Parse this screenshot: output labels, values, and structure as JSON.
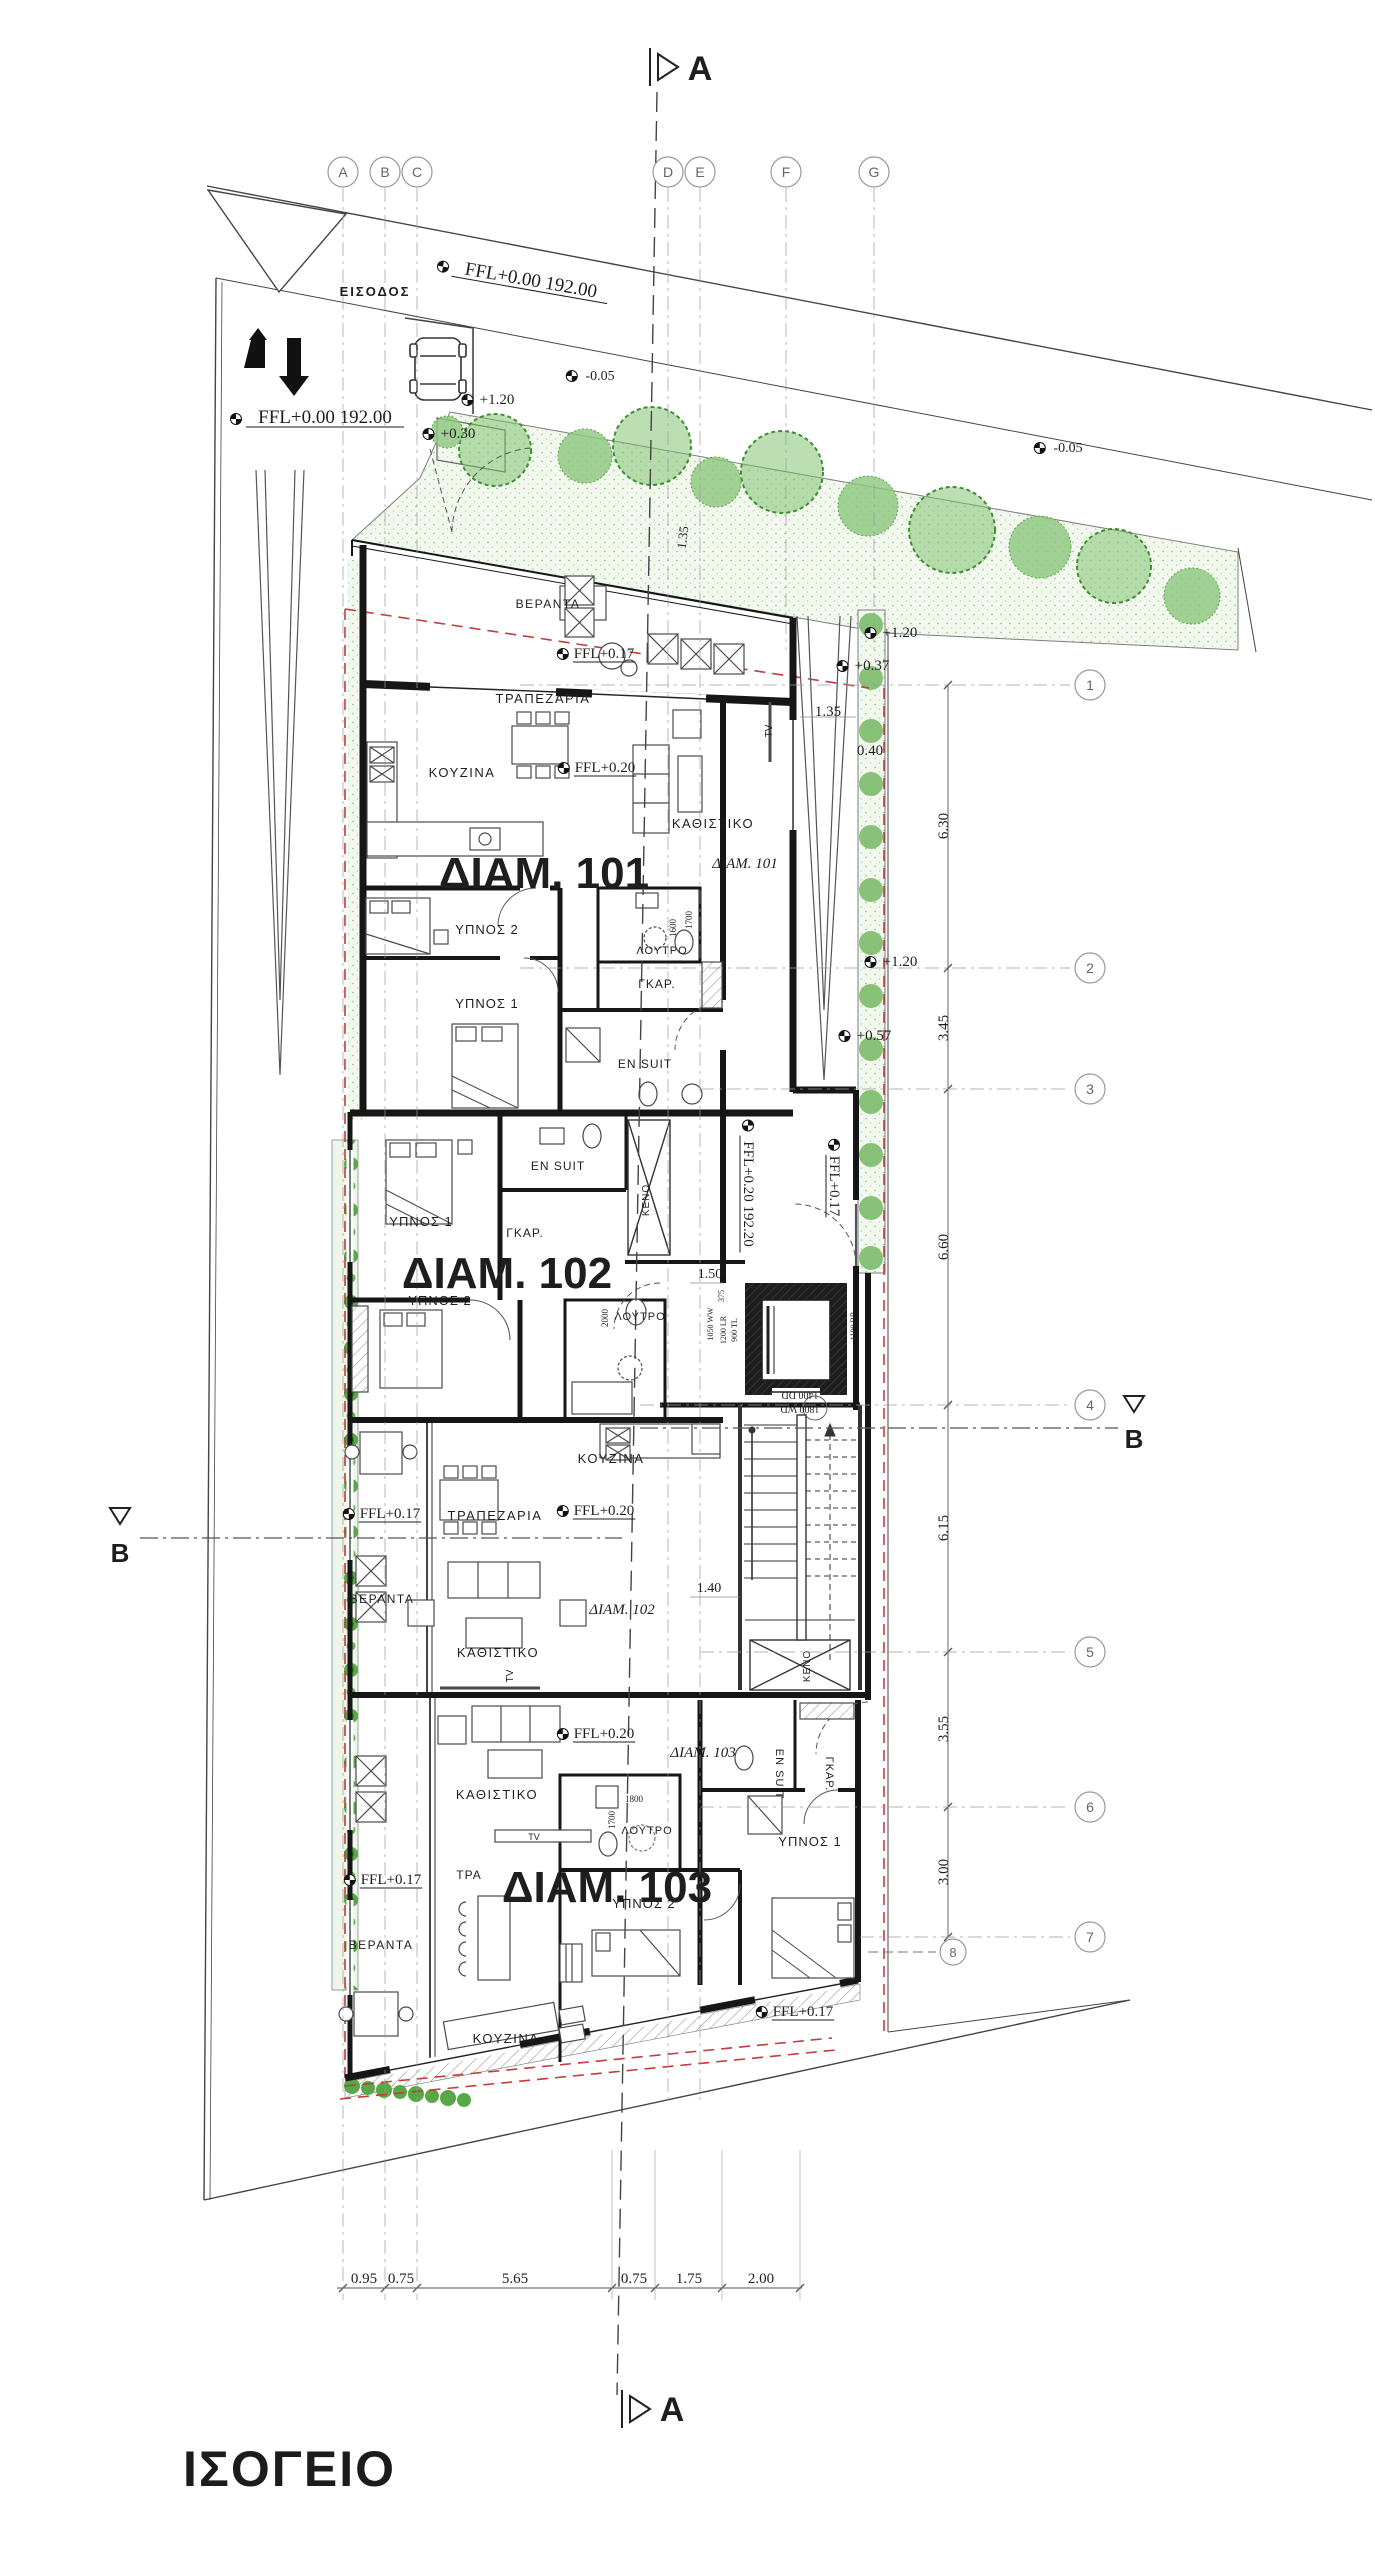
{
  "title": "ΙΣΟΓΕΙΟ",
  "colors": {
    "wall": "#161616",
    "line": "#3a3a3a",
    "green_tree": "#5aa84b",
    "green_bg": "#f3f8ef",
    "red_boundary": "#c43c3c",
    "grid_gray": "#8a8a8a",
    "text": "#222222"
  },
  "grid": {
    "columns": [
      {
        "label": "A",
        "x": 343,
        "end": 2300
      },
      {
        "label": "B",
        "x": 385,
        "end": 2300
      },
      {
        "label": "C",
        "x": 417,
        "end": 2300
      },
      {
        "label": "D",
        "x": 668,
        "end": 2105
      },
      {
        "label": "E",
        "x": 700,
        "end": 2105
      },
      {
        "label": "F",
        "x": 786,
        "end": 650
      },
      {
        "label": "G",
        "x": 874,
        "end": 650
      }
    ],
    "rows": [
      {
        "label": "1",
        "y": 685,
        "x0": 520
      },
      {
        "label": "2",
        "y": 968,
        "x0": 520
      },
      {
        "label": "3",
        "y": 1089,
        "x0": 700
      },
      {
        "label": "4",
        "y": 1405,
        "x0": 640
      },
      {
        "label": "5",
        "y": 1652,
        "x0": 700
      },
      {
        "label": "6",
        "y": 1807,
        "x0": 700
      },
      {
        "label": "7",
        "y": 1937,
        "x0": 860
      }
    ],
    "extra_row": {
      "label": "8",
      "cx": 953,
      "cy": 1952
    }
  },
  "plan": {
    "labels": [
      {
        "n": "entrance-label",
        "t": "ΕΙΣΟΔΟΣ",
        "x": 375,
        "y": 296,
        "s": 13,
        "w": 700,
        "ls": 2
      },
      {
        "n": "ffl-street",
        "t": "FFL+0.00  192.00",
        "x": 530,
        "y": 286,
        "s": 19,
        "f": "serif",
        "r": 10,
        "u": 1,
        "m": 1
      },
      {
        "n": "ffl-drive",
        "t": "FFL+0.00  192.00",
        "x": 325,
        "y": 423,
        "s": 19,
        "f": "serif",
        "u": 1,
        "m": 1
      },
      {
        "t": "+1.20",
        "x": 497,
        "y": 404,
        "s": 15,
        "f": "serif",
        "m": 1
      },
      {
        "t": "+0.30",
        "x": 458,
        "y": 438,
        "s": 15,
        "f": "serif",
        "m": 1
      },
      {
        "t": "-0.05",
        "x": 600,
        "y": 380,
        "s": 14,
        "f": "serif",
        "m": 1
      },
      {
        "t": "-0.05",
        "x": 1068,
        "y": 452,
        "s": 14,
        "f": "serif",
        "m": 1
      },
      {
        "t": "+1.20",
        "x": 900,
        "y": 637,
        "s": 15,
        "f": "serif",
        "m": 1
      },
      {
        "t": "+0.37",
        "x": 872,
        "y": 670,
        "s": 15,
        "f": "serif",
        "m": 1
      },
      {
        "t": "1.35",
        "x": 828,
        "y": 716,
        "s": 15,
        "f": "serif"
      },
      {
        "t": "0.40",
        "x": 870,
        "y": 755,
        "s": 15,
        "f": "serif"
      },
      {
        "t": "1.35",
        "x": 687,
        "y": 538,
        "s": 13,
        "f": "serif",
        "r": -83
      },
      {
        "t": "+1.20",
        "x": 900,
        "y": 966,
        "s": 15,
        "f": "serif",
        "m": 1
      },
      {
        "t": "+0.57",
        "x": 874,
        "y": 1040,
        "s": 15,
        "f": "serif",
        "m": 1
      },
      {
        "t": "ΒΕΡΑΝΤΑ",
        "x": 548,
        "y": 608,
        "s": 12,
        "ls": 1.5
      },
      {
        "t": "FFL+0.17",
        "x": 604,
        "y": 658,
        "s": 15,
        "f": "serif",
        "u": 1,
        "m": 1
      },
      {
        "t": "ΤΡΑΠΕΖΑΡΙΑ",
        "x": 543,
        "y": 703,
        "s": 13,
        "ls": 1.5
      },
      {
        "t": "ΚΟΥΖΙΝΑ",
        "x": 462,
        "y": 777,
        "s": 13,
        "ls": 1.5
      },
      {
        "t": "FFL+0.20",
        "x": 605,
        "y": 772,
        "s": 15,
        "f": "serif",
        "u": 1,
        "m": 1
      },
      {
        "t": "ΚΑΘΙΣΤΙΚΟ",
        "x": 713,
        "y": 828,
        "s": 13,
        "ls": 1.5
      },
      {
        "n": "apt-101-big",
        "t": "ΔΙΑΜ. 101",
        "x": 544,
        "y": 888,
        "s": 44,
        "w": 800
      },
      {
        "n": "apt-101-small",
        "t": "ΔΙΑΜ. 101",
        "x": 745,
        "y": 868,
        "s": 15,
        "f": "serif",
        "i": 1
      },
      {
        "t": "ΥΠΝΟΣ 2",
        "x": 487,
        "y": 934,
        "s": 13,
        "ls": 1
      },
      {
        "t": "ΛΟΥΤΡΟ",
        "x": 662,
        "y": 954,
        "s": 11,
        "ls": 1
      },
      {
        "t": "1600",
        "x": 676,
        "y": 928,
        "s": 9,
        "f": "serif",
        "r": -90
      },
      {
        "t": "1700",
        "x": 692,
        "y": 920,
        "s": 9,
        "f": "serif",
        "r": -90
      },
      {
        "t": "ΓΚΑΡ.",
        "x": 657,
        "y": 988,
        "s": 12,
        "ls": 1
      },
      {
        "t": "ΥΠΝΟΣ 1",
        "x": 487,
        "y": 1008,
        "s": 13,
        "ls": 1
      },
      {
        "t": "EN SUIT",
        "x": 645,
        "y": 1068,
        "s": 12,
        "ls": 1
      },
      {
        "t": "TV",
        "x": 772,
        "y": 731,
        "s": 10,
        "r": -90
      },
      {
        "t": "FFL+0.17",
        "x": 830,
        "y": 1186,
        "s": 15,
        "f": "serif",
        "r": 90,
        "u": 1,
        "m": 1
      },
      {
        "t": "FFL+0.20 192.20",
        "x": 744,
        "y": 1194,
        "s": 15,
        "f": "serif",
        "r": 90,
        "u": 1,
        "m": 1
      },
      {
        "t": "1.50",
        "x": 710,
        "y": 1278,
        "s": 14,
        "f": "serif"
      },
      {
        "t": "375",
        "x": 724,
        "y": 1296,
        "s": 8,
        "f": "serif",
        "r": -90
      },
      {
        "t": "1050 WW",
        "x": 713,
        "y": 1324,
        "s": 8,
        "f": "serif",
        "r": -90
      },
      {
        "t": "1200 LR",
        "x": 726,
        "y": 1330,
        "s": 8,
        "f": "serif",
        "r": -90
      },
      {
        "t": "900 TL",
        "x": 737,
        "y": 1330,
        "s": 8,
        "f": "serif",
        "r": -90
      },
      {
        "t": "1100 BB",
        "x": 856,
        "y": 1326,
        "s": 8,
        "f": "serif",
        "r": -90
      },
      {
        "t": "1400 DD",
        "x": 800,
        "y": 1392,
        "s": 10,
        "f": "serif",
        "r": 180
      },
      {
        "t": "1800 WD",
        "x": 800,
        "y": 1406,
        "s": 10,
        "f": "serif",
        "r": 180
      },
      {
        "t": "EN SUIT",
        "x": 558,
        "y": 1170,
        "s": 12,
        "ls": 1
      },
      {
        "t": "ΥΠΝΟΣ 1",
        "x": 421,
        "y": 1226,
        "s": 13,
        "ls": 1
      },
      {
        "t": "ΓΚΑΡ.",
        "x": 525,
        "y": 1237,
        "s": 12,
        "ls": 1
      },
      {
        "n": "apt-102-big",
        "t": "ΔΙΑΜ. 102",
        "x": 507,
        "y": 1288,
        "s": 44,
        "w": 800
      },
      {
        "t": "ΥΠΝΟΣ 2",
        "x": 440,
        "y": 1305,
        "s": 13,
        "ls": 1
      },
      {
        "t": "ΚΕΝΟ",
        "x": 649,
        "y": 1200,
        "s": 10,
        "r": -90,
        "ls": 1
      },
      {
        "t": "2000",
        "x": 608,
        "y": 1318,
        "s": 9,
        "f": "serif",
        "r": -90
      },
      {
        "t": "ΛΟΥΤΡΟ",
        "x": 640,
        "y": 1320,
        "s": 11,
        "ls": 1
      },
      {
        "t": "ΚΟΥΖΙΝΑ",
        "x": 611,
        "y": 1463,
        "s": 13,
        "ls": 1.5
      },
      {
        "t": "FFL+0.17",
        "x": 390,
        "y": 1518,
        "s": 15,
        "f": "serif",
        "u": 1,
        "m": 1
      },
      {
        "t": "FFL+0.20",
        "x": 604,
        "y": 1515,
        "s": 15,
        "f": "serif",
        "u": 1,
        "m": 1
      },
      {
        "t": "ΤΡΑΠΕΖΑΡΙΑ",
        "x": 495,
        "y": 1520,
        "s": 13,
        "ls": 1.5
      },
      {
        "t": "ΒΕΡΑΝΤΑ",
        "x": 382,
        "y": 1603,
        "s": 12,
        "ls": 1.5
      },
      {
        "t": "ΚΑΘΙΣΤΙΚΟ",
        "x": 498,
        "y": 1657,
        "s": 13,
        "ls": 1.5
      },
      {
        "n": "apt-102-small",
        "t": "ΔΙΑΜ. 102",
        "x": 622,
        "y": 1614,
        "s": 15,
        "f": "serif",
        "i": 1
      },
      {
        "t": "1.40",
        "x": 709,
        "y": 1592,
        "s": 14,
        "f": "serif"
      },
      {
        "t": "ΚΑΘΙΣΤΙΚΟ",
        "x": 497,
        "y": 1799,
        "s": 13,
        "ls": 1.5
      },
      {
        "t": "FFL+0.20",
        "x": 604,
        "y": 1738,
        "s": 15,
        "f": "serif",
        "u": 1,
        "m": 1
      },
      {
        "n": "apt-103-small",
        "t": "ΔΙΑΜ. 103",
        "x": 703,
        "y": 1757,
        "s": 15,
        "f": "serif",
        "i": 1
      },
      {
        "t": "EN SUIT",
        "x": 776,
        "y": 1774,
        "s": 11,
        "r": 90,
        "ls": 1
      },
      {
        "t": "ΓΚΑΡ.",
        "x": 826,
        "y": 1774,
        "s": 11,
        "r": 90,
        "ls": 1
      },
      {
        "t": "ΚΕΝΟ",
        "x": 810,
        "y": 1666,
        "s": 10,
        "r": -90,
        "ls": 1
      },
      {
        "t": "ΥΠΝΟΣ 1",
        "x": 810,
        "y": 1846,
        "s": 13,
        "ls": 1
      },
      {
        "t": "ΛΟΥΤΡΟ",
        "x": 647,
        "y": 1834,
        "s": 11,
        "ls": 1
      },
      {
        "t": "1800",
        "x": 634,
        "y": 1802,
        "s": 9,
        "f": "serif"
      },
      {
        "t": "1700",
        "x": 615,
        "y": 1820,
        "s": 9,
        "f": "serif",
        "r": -90
      },
      {
        "t": "TV",
        "x": 513,
        "y": 1676,
        "s": 10,
        "r": -90
      },
      {
        "t": "TV",
        "x": 534,
        "y": 1840,
        "s": 9
      },
      {
        "n": "apt-103-big",
        "t": "ΔΙΑΜ. 103",
        "x": 607,
        "y": 1902,
        "s": 44,
        "w": 800
      },
      {
        "t": "ΤΡΑ",
        "x": 469,
        "y": 1879,
        "s": 12,
        "ls": 1
      },
      {
        "t": "ΥΠΝΟΣ 2",
        "x": 644,
        "y": 1908,
        "s": 13,
        "ls": 1
      },
      {
        "t": "ΒΕΡΑΝΤΑ",
        "x": 381,
        "y": 1949,
        "s": 12,
        "ls": 1.5
      },
      {
        "t": "FFL+0.17",
        "x": 391,
        "y": 1884,
        "s": 15,
        "f": "serif",
        "u": 1,
        "m": 1
      },
      {
        "t": "ΚΟΥΖΙΝΑ",
        "x": 506,
        "y": 2043,
        "s": 13,
        "ls": 1.5
      },
      {
        "t": "FFL+0.17",
        "x": 803,
        "y": 2016,
        "s": 15,
        "f": "serif",
        "u": 1,
        "m": 1
      },
      {
        "n": "dim-bottom-1",
        "t": "0.95",
        "x": 364,
        "y": 2283,
        "s": 15,
        "f": "serif"
      },
      {
        "n": "dim-bottom-2",
        "t": "0.75",
        "x": 401,
        "y": 2283,
        "s": 15,
        "f": "serif"
      },
      {
        "n": "dim-bottom-3",
        "t": "5.65",
        "x": 515,
        "y": 2283,
        "s": 15,
        "f": "serif"
      },
      {
        "n": "dim-bottom-4",
        "t": "0.75",
        "x": 634,
        "y": 2283,
        "s": 15,
        "f": "serif"
      },
      {
        "n": "dim-bottom-5",
        "t": "1.75",
        "x": 689,
        "y": 2283,
        "s": 15,
        "f": "serif"
      },
      {
        "n": "dim-bottom-6",
        "t": "2.00",
        "x": 761,
        "y": 2283,
        "s": 15,
        "f": "serif"
      },
      {
        "n": "dim-right-1",
        "t": "6.30",
        "x": 948,
        "y": 826,
        "s": 15,
        "f": "serif",
        "r": -90
      },
      {
        "n": "dim-right-2",
        "t": "3.45",
        "x": 948,
        "y": 1028,
        "s": 15,
        "f": "serif",
        "r": -90
      },
      {
        "n": "dim-right-3",
        "t": "6.60",
        "x": 948,
        "y": 1247,
        "s": 15,
        "f": "serif",
        "r": -90
      },
      {
        "n": "dim-right-4",
        "t": "6.15",
        "x": 948,
        "y": 1528,
        "s": 15,
        "f": "serif",
        "r": -90
      },
      {
        "n": "dim-right-5",
        "t": "3.55",
        "x": 948,
        "y": 1729,
        "s": 15,
        "f": "serif",
        "r": -90
      },
      {
        "n": "dim-right-6",
        "t": "3.00",
        "x": 948,
        "y": 1872,
        "s": 15,
        "f": "serif",
        "r": -90
      },
      {
        "n": "section-a-top",
        "t": "A",
        "x": 700,
        "y": 80,
        "s": 34,
        "w": 700
      },
      {
        "n": "section-a-bottom",
        "t": "A",
        "x": 672,
        "y": 2421,
        "s": 34,
        "w": 700
      },
      {
        "n": "section-b-left",
        "t": "B",
        "x": 120,
        "y": 1562,
        "s": 26,
        "w": 700
      },
      {
        "n": "section-b-right",
        "t": "B",
        "x": 1134,
        "y": 1448,
        "s": 26,
        "w": 700
      }
    ]
  }
}
